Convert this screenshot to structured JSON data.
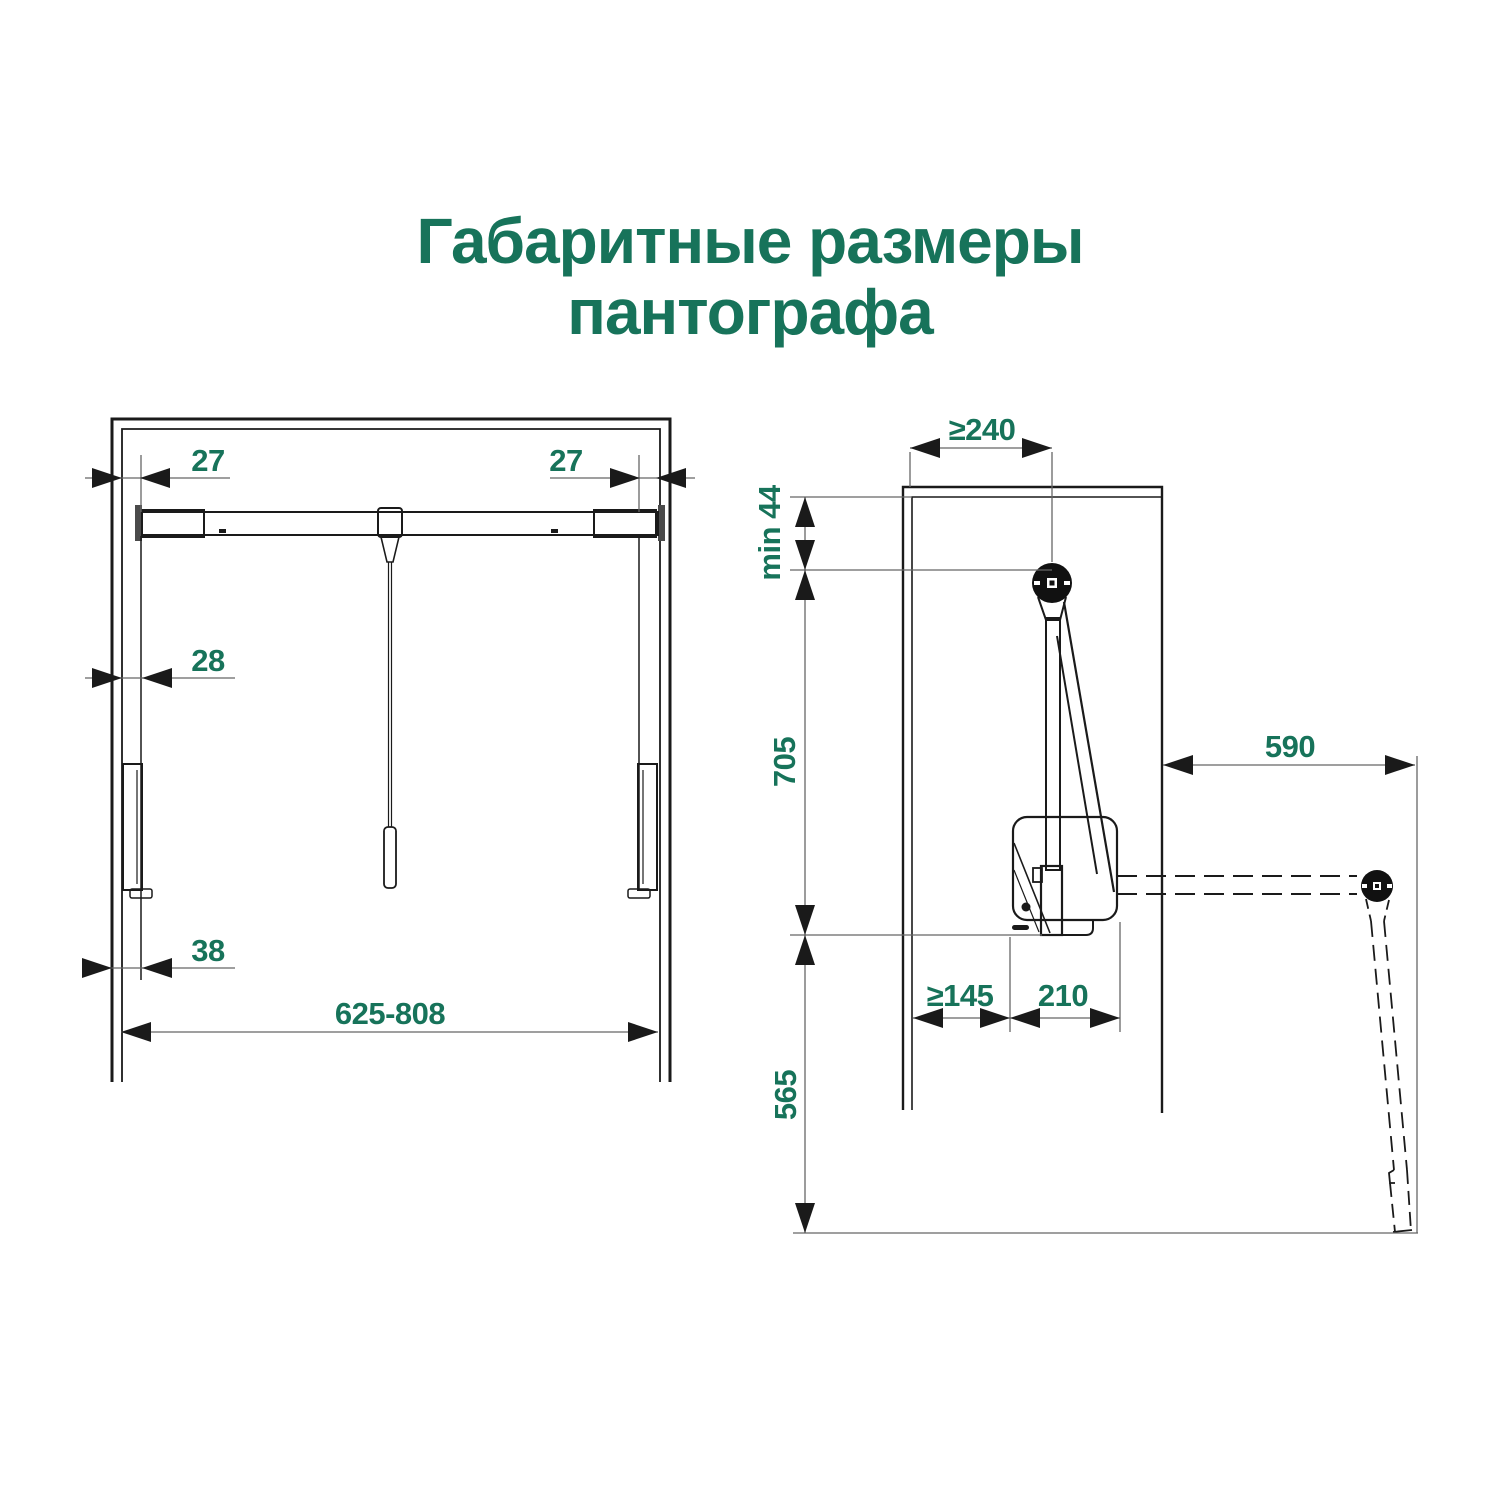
{
  "title": {
    "line1": "Габаритные размеры",
    "line2": "пантографа"
  },
  "colors": {
    "accent_green": "#17735A",
    "drawing_line": "#1A1A1A",
    "dimension_line": "#666666",
    "background": "#FFFFFF"
  },
  "front_view": {
    "dim_top_left": "27",
    "dim_top_right": "27",
    "dim_rail": "28",
    "dim_bottom": "38",
    "dim_width": "625-808"
  },
  "side_view": {
    "dim_depth": "≥240",
    "dim_top_gap": "min 44",
    "dim_upper_height": "705",
    "dim_reach": "590",
    "dim_back_gap": "≥145",
    "dim_body": "210",
    "dim_lower_height": "565"
  }
}
